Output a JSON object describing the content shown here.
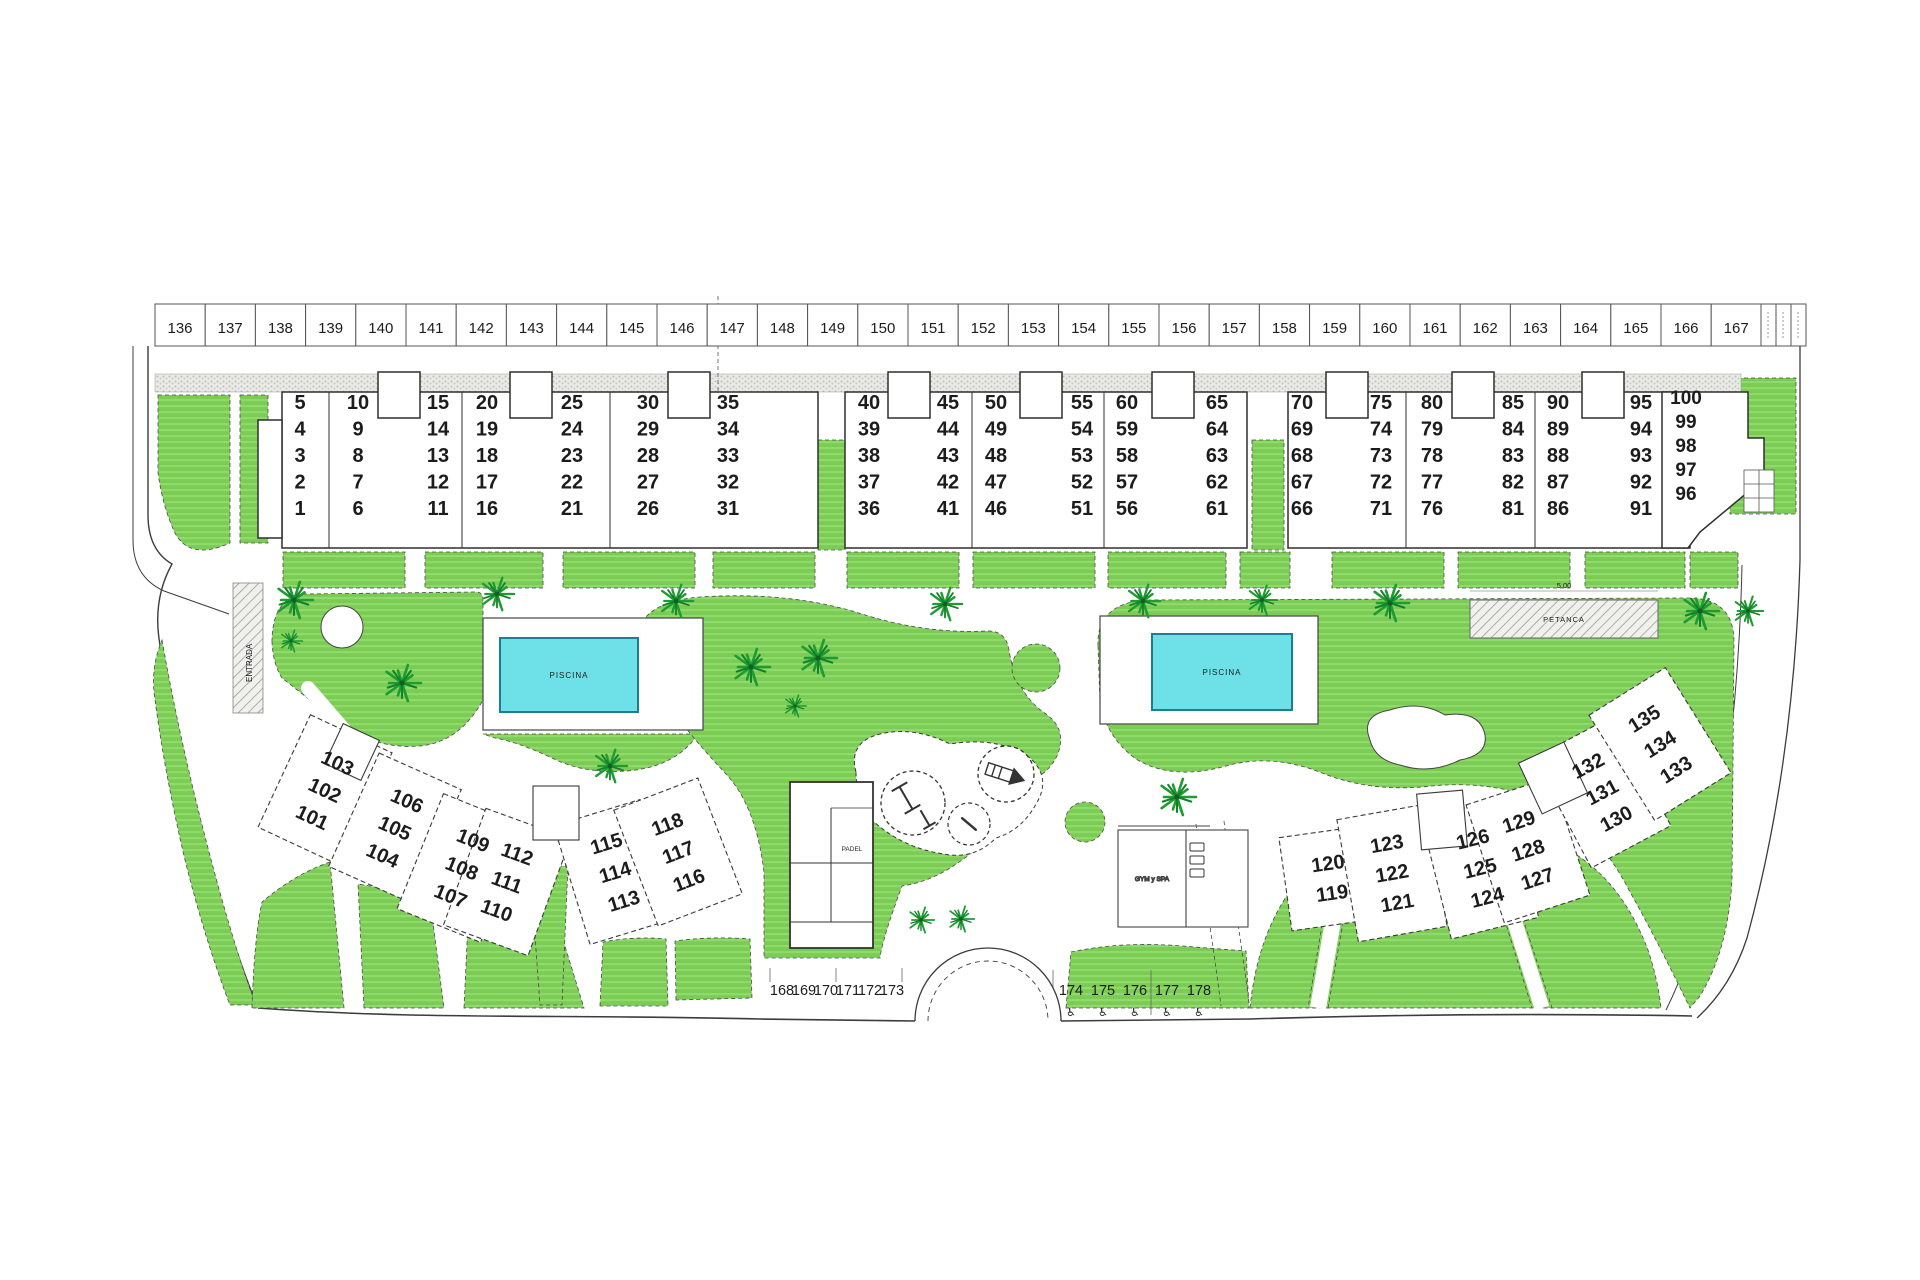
{
  "plan": {
    "title": "residential-site-plan",
    "parking_row_top": [
      "136",
      "137",
      "138",
      "139",
      "140",
      "141",
      "142",
      "143",
      "144",
      "145",
      "146",
      "147",
      "148",
      "149",
      "150",
      "151",
      "152",
      "153",
      "154",
      "155",
      "156",
      "157",
      "158",
      "159",
      "160",
      "161",
      "162",
      "163",
      "164",
      "165",
      "166",
      "167"
    ],
    "parking_row_bottom_left": [
      "168",
      "169",
      "170",
      "171",
      "172",
      "173"
    ],
    "parking_row_bottom_right": [
      "174",
      "175",
      "176",
      "177",
      "178"
    ],
    "upper_buildings": [
      {
        "name": "block-1-35",
        "columns": [
          [
            "5",
            "4",
            "3",
            "2",
            "1"
          ],
          [
            "10",
            "9",
            "8",
            "7",
            "6"
          ],
          [
            "15",
            "14",
            "13",
            "12",
            "11"
          ],
          [
            "20",
            "19",
            "18",
            "17",
            "16"
          ],
          [
            "25",
            "24",
            "23",
            "22",
            "21"
          ],
          [
            "30",
            "29",
            "28",
            "27",
            "26"
          ],
          [
            "35",
            "34",
            "33",
            "32",
            "31"
          ]
        ]
      },
      {
        "name": "block-36-65",
        "columns": [
          [
            "40",
            "39",
            "38",
            "37",
            "36"
          ],
          [
            "45",
            "44",
            "43",
            "42",
            "41"
          ],
          [
            "50",
            "49",
            "48",
            "47",
            "46"
          ],
          [
            "55",
            "54",
            "53",
            "52",
            "51"
          ],
          [
            "60",
            "59",
            "58",
            "57",
            "56"
          ],
          [
            "65",
            "64",
            "63",
            "62",
            "61"
          ]
        ]
      },
      {
        "name": "block-66-100",
        "columns": [
          [
            "70",
            "69",
            "68",
            "67",
            "66"
          ],
          [
            "75",
            "74",
            "73",
            "72",
            "71"
          ],
          [
            "80",
            "79",
            "78",
            "77",
            "76"
          ],
          [
            "85",
            "84",
            "83",
            "82",
            "81"
          ],
          [
            "90",
            "89",
            "88",
            "87",
            "86"
          ],
          [
            "95",
            "94",
            "93",
            "92",
            "91"
          ],
          [
            "100",
            "99",
            "98",
            "97",
            "96"
          ]
        ]
      }
    ],
    "lower_left_building": {
      "groups": [
        [
          "103",
          "102",
          "101"
        ],
        [
          "106",
          "105",
          "104"
        ],
        [
          "109",
          "108",
          "107"
        ],
        [
          "112",
          "111",
          "110"
        ],
        [
          "115",
          "114",
          "113"
        ],
        [
          "118",
          "117",
          "116"
        ]
      ]
    },
    "lower_right_building": {
      "groups": [
        [
          "120",
          "119"
        ],
        [
          "123",
          "122",
          "121"
        ],
        [
          "126",
          "125",
          "124"
        ],
        [
          "129",
          "128",
          "127"
        ],
        [
          "132",
          "131",
          "130"
        ],
        [
          "135",
          "134",
          "133"
        ]
      ]
    },
    "labels": {
      "pool": "PISCINA",
      "padel": "PADEL",
      "petanca": "PETANCA",
      "petanca_dim": "5.00",
      "gym": "GYM y SPA",
      "entrance": "ENTRADA",
      "accessible_icon": "♿"
    },
    "colors": {
      "grass": "#7ccb55",
      "grass_light": "#8eda6b",
      "palm": "#1d9c31",
      "pool_water": "#6ee0e8",
      "pool_border": "#1c7f8f",
      "outline": "#2f2f2f",
      "text": "#1c1c1c"
    }
  }
}
